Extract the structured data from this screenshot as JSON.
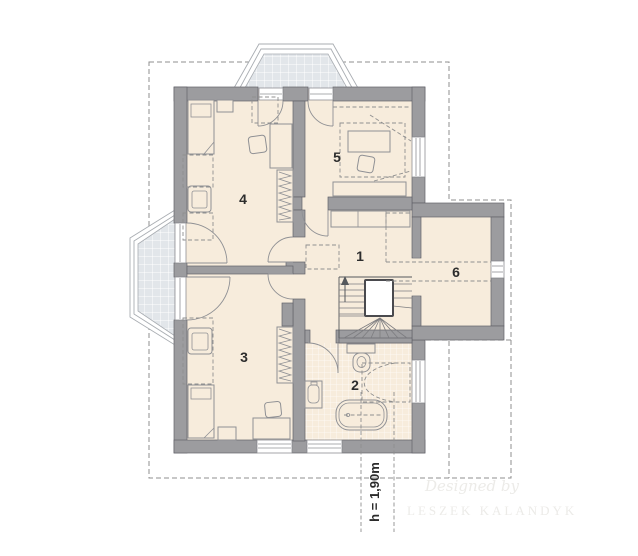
{
  "plan": {
    "rooms": [
      {
        "label": "1"
      },
      {
        "label": "2"
      },
      {
        "label": "3"
      },
      {
        "label": "4"
      },
      {
        "label": "5"
      },
      {
        "label": "6"
      }
    ],
    "annotation": {
      "height_label": "h = 1,90m"
    },
    "watermark": {
      "line1": "Designed by",
      "line2": "LESZEK KALANDYK"
    }
  },
  "colors": {
    "background": "#ffffff",
    "wall_fill": "#9c9c9f",
    "wall_stroke": "#63636a",
    "floor_fill": "#f7ecdc",
    "balcony_tile": "#e2e6ea",
    "furniture_stroke": "#8f9094",
    "dashed_line": "#8f8f8f",
    "label_color": "#2d2d2d",
    "watermark_color": "#ecebe8"
  }
}
